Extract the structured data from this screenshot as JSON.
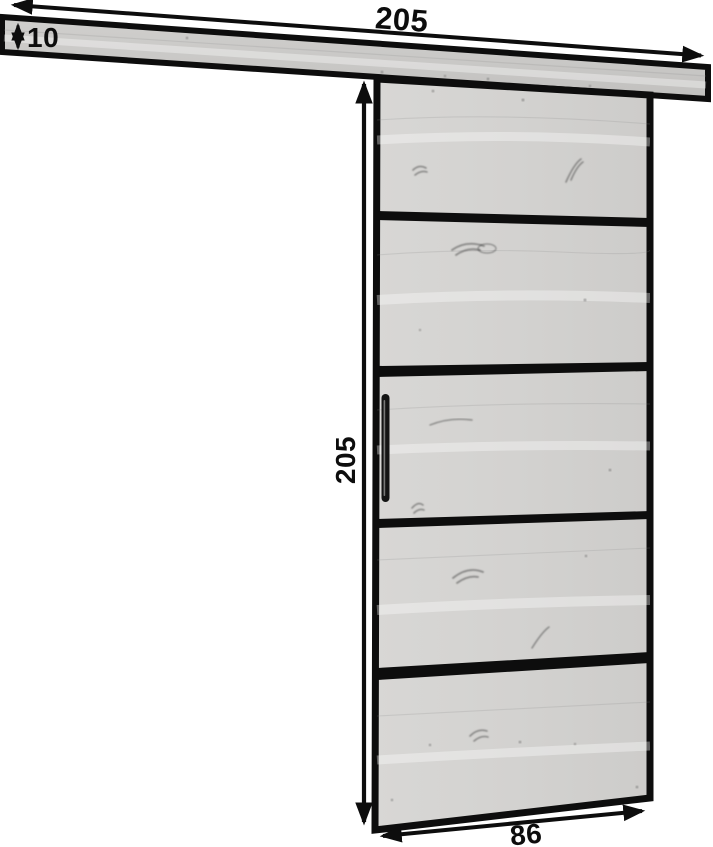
{
  "diagram": {
    "labels": {
      "rail_length": "205",
      "rail_thickness": "10",
      "door_height": "205",
      "door_width": "86"
    },
    "icons": {
      "dimension_arrows": "double-headed-arrow"
    },
    "colors": {
      "background": "#ffffff",
      "outline": "#0d0d0d",
      "rail_wood": "#c9c8c6",
      "door_wood": "#d4d3d1",
      "divider_bar": "#0d0d0d",
      "handle": "#141414"
    }
  }
}
